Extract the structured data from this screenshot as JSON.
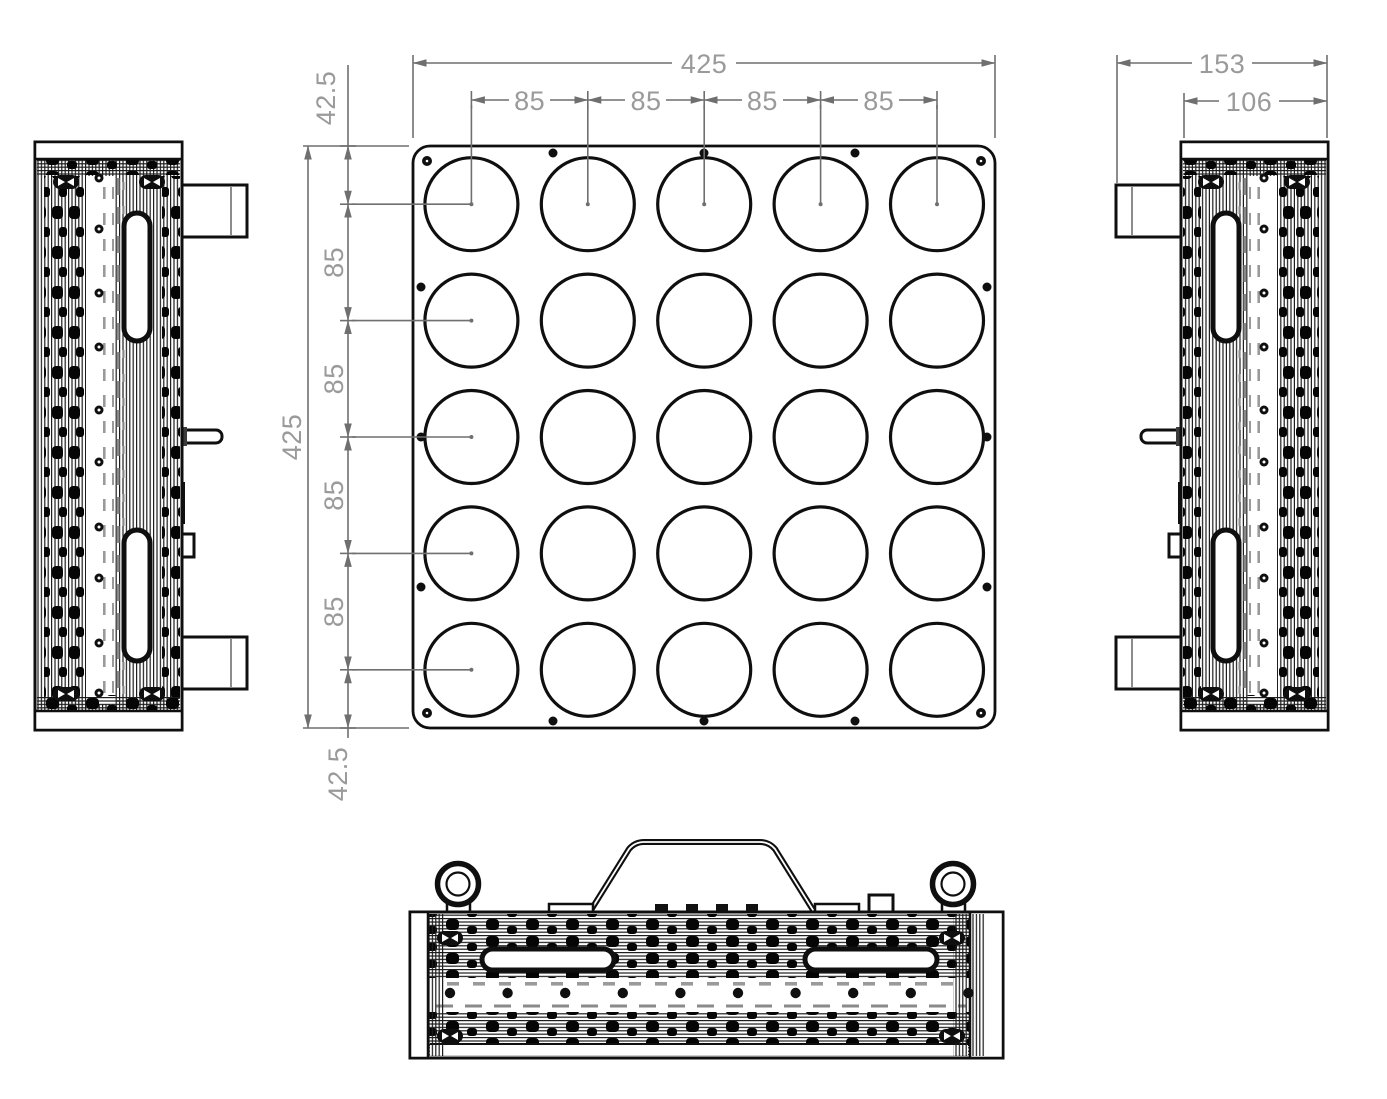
{
  "drawing_type": "mechanical-dimension-drawing",
  "dims": {
    "front": {
      "overall_width": "425",
      "overall_height": "425",
      "col_pitch": [
        "85",
        "85",
        "85",
        "85"
      ],
      "row_pitch": [
        "85",
        "85",
        "85",
        "85"
      ],
      "margin_top": "42.5",
      "margin_bottom": "42.5"
    },
    "side": {
      "overall_depth": "153",
      "body_depth": "106"
    }
  },
  "geometry": {
    "plate_mm": {
      "width": 425,
      "height": 425
    },
    "hole_grid": {
      "rows": 5,
      "cols": 5,
      "pitch_mm": 85,
      "edge_margin_mm": 42.5,
      "hole_count": 25
    },
    "depth_mm": {
      "overall": 153,
      "body": 106
    },
    "perimeter_screws": {
      "corner": 4,
      "top": 3,
      "bottom": 3,
      "left": 3,
      "right": 3
    },
    "side_view_screw_count": 10,
    "bottom_view_screw_count": 10,
    "heatsink_slots_per_side": 2,
    "eye_bolts": 2
  },
  "colors": {
    "line_black": "#0f0f0f",
    "dim_line_gray": "#6f6f6f",
    "dim_text_gray": "#9a9a9a",
    "background": "#ffffff"
  }
}
